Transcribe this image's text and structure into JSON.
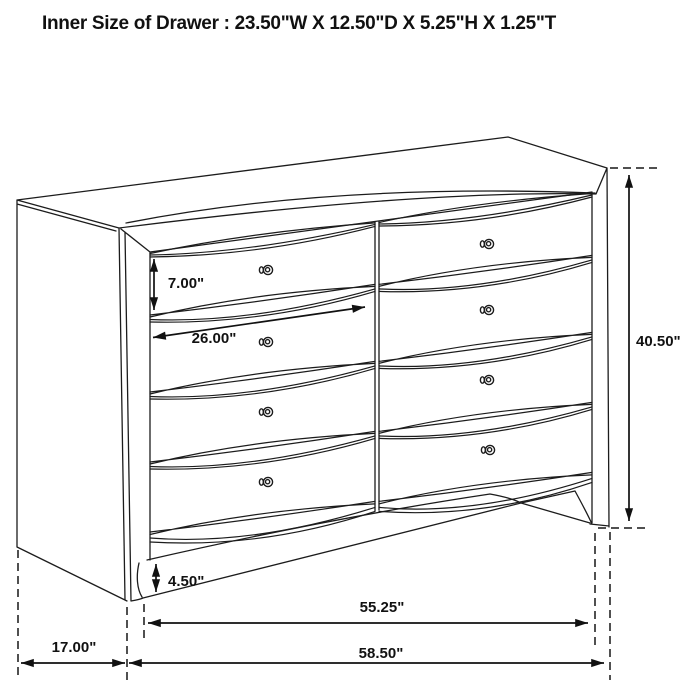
{
  "title": "Inner Size of Drawer : 23.50\"W X 12.50\"D X 5.25\"H X 1.25\"T",
  "drawing": {
    "subject": "8-drawer dresser line drawing with dimension arrows",
    "colors": {
      "line": "#1c1c1c",
      "background": "#ffffff"
    },
    "dimensions": {
      "drawer_face_height": "7.00\"",
      "drawer_width": "26.00\"",
      "overall_height": "40.50\"",
      "base_leg_height": "4.50\"",
      "front_feet_width": "55.25\"",
      "side_depth": "17.00\"",
      "overall_width": "58.50\""
    }
  }
}
